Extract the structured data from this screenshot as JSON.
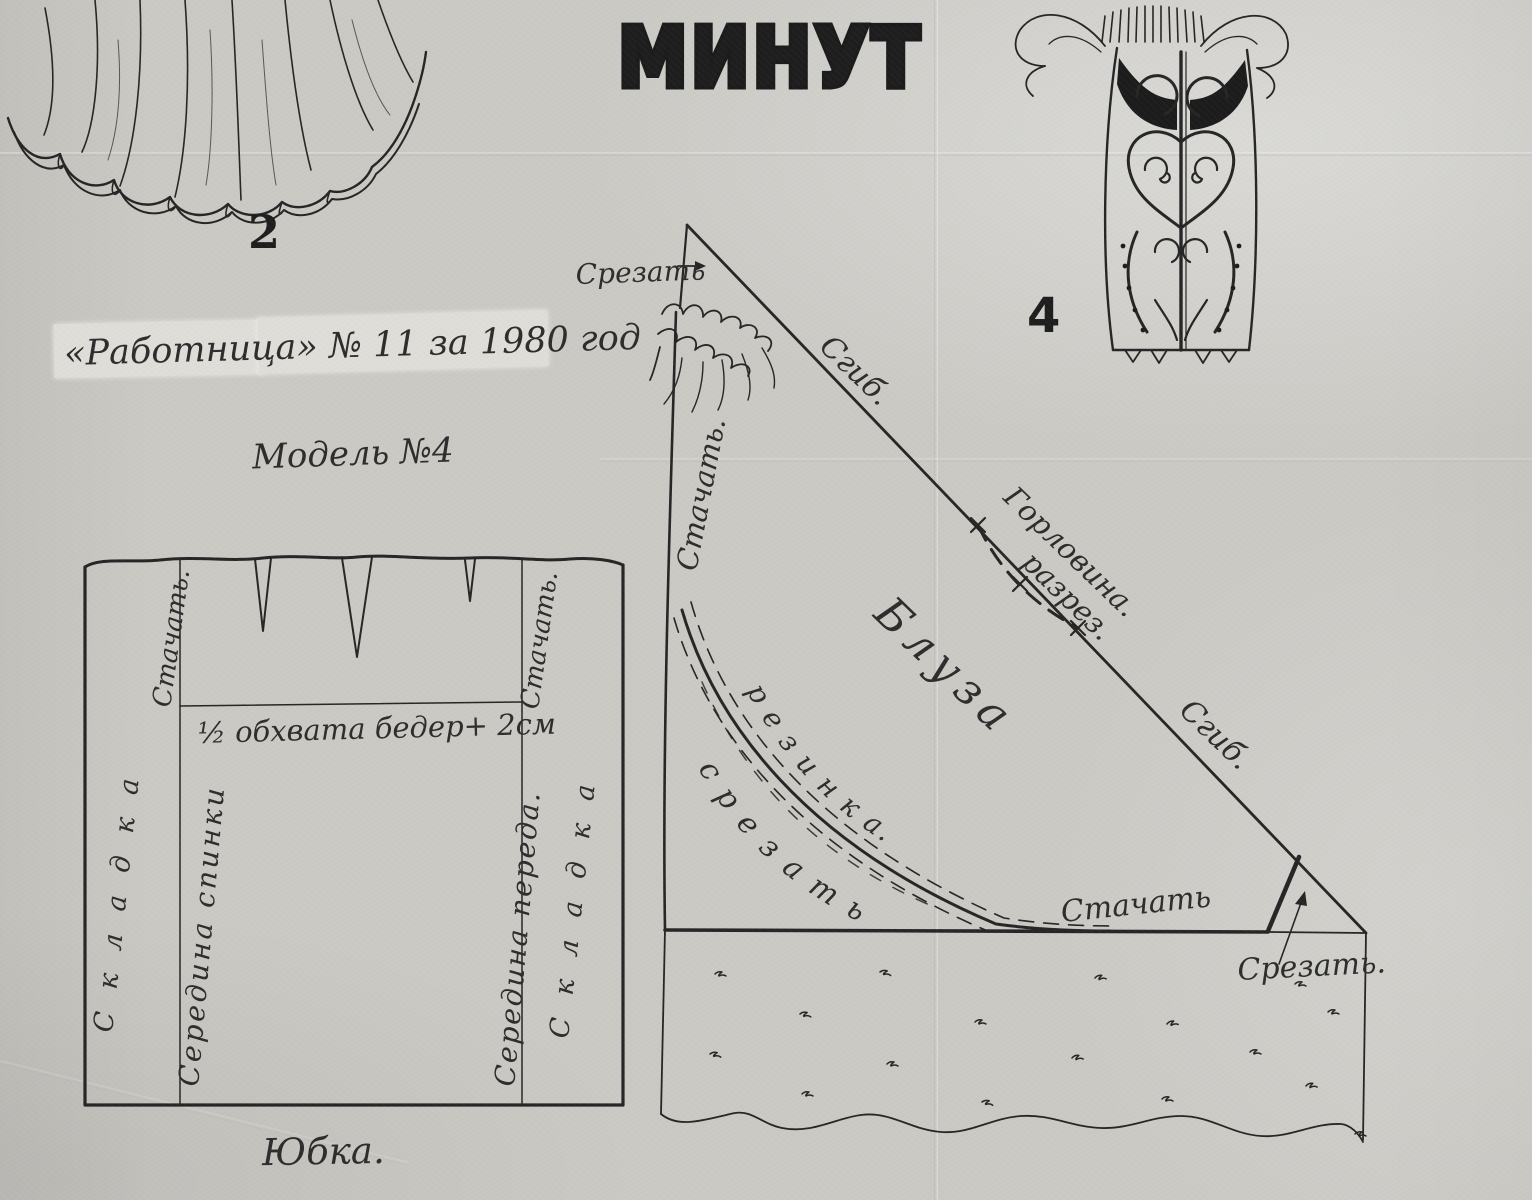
{
  "page": {
    "title": "МИНУТ",
    "figure2_label": "2",
    "figure4_label": "4",
    "source_line": "«Работница»  № 11  за  1980  год",
    "model_line": "Модель №4"
  },
  "skirt": {
    "caption": "Юбка.",
    "labels": {
      "stitch_left": "Стачать.",
      "stitch_right": "Стачать.",
      "hip_measure": "½ обхвата бедер+ 2см",
      "pleat_left": "С к л а д к а",
      "pleat_right": "С к л а д к а",
      "center_back": "Середина спинки",
      "center_front": "Середина переда."
    }
  },
  "blouse": {
    "name": "Блуза",
    "labels": {
      "cut_top": "Срезать",
      "fold_upper": "Сгиб.",
      "fold_lower": "Сгиб.",
      "stitch_side": "Стачать.",
      "neckline": "Горловина.",
      "slit": "разрез.",
      "elastic": "р е з и н к а.",
      "cut_along_curve": "с р е з а т ь",
      "stitch_bottom": "Стачать",
      "cut_corner": "Срезать."
    }
  }
}
